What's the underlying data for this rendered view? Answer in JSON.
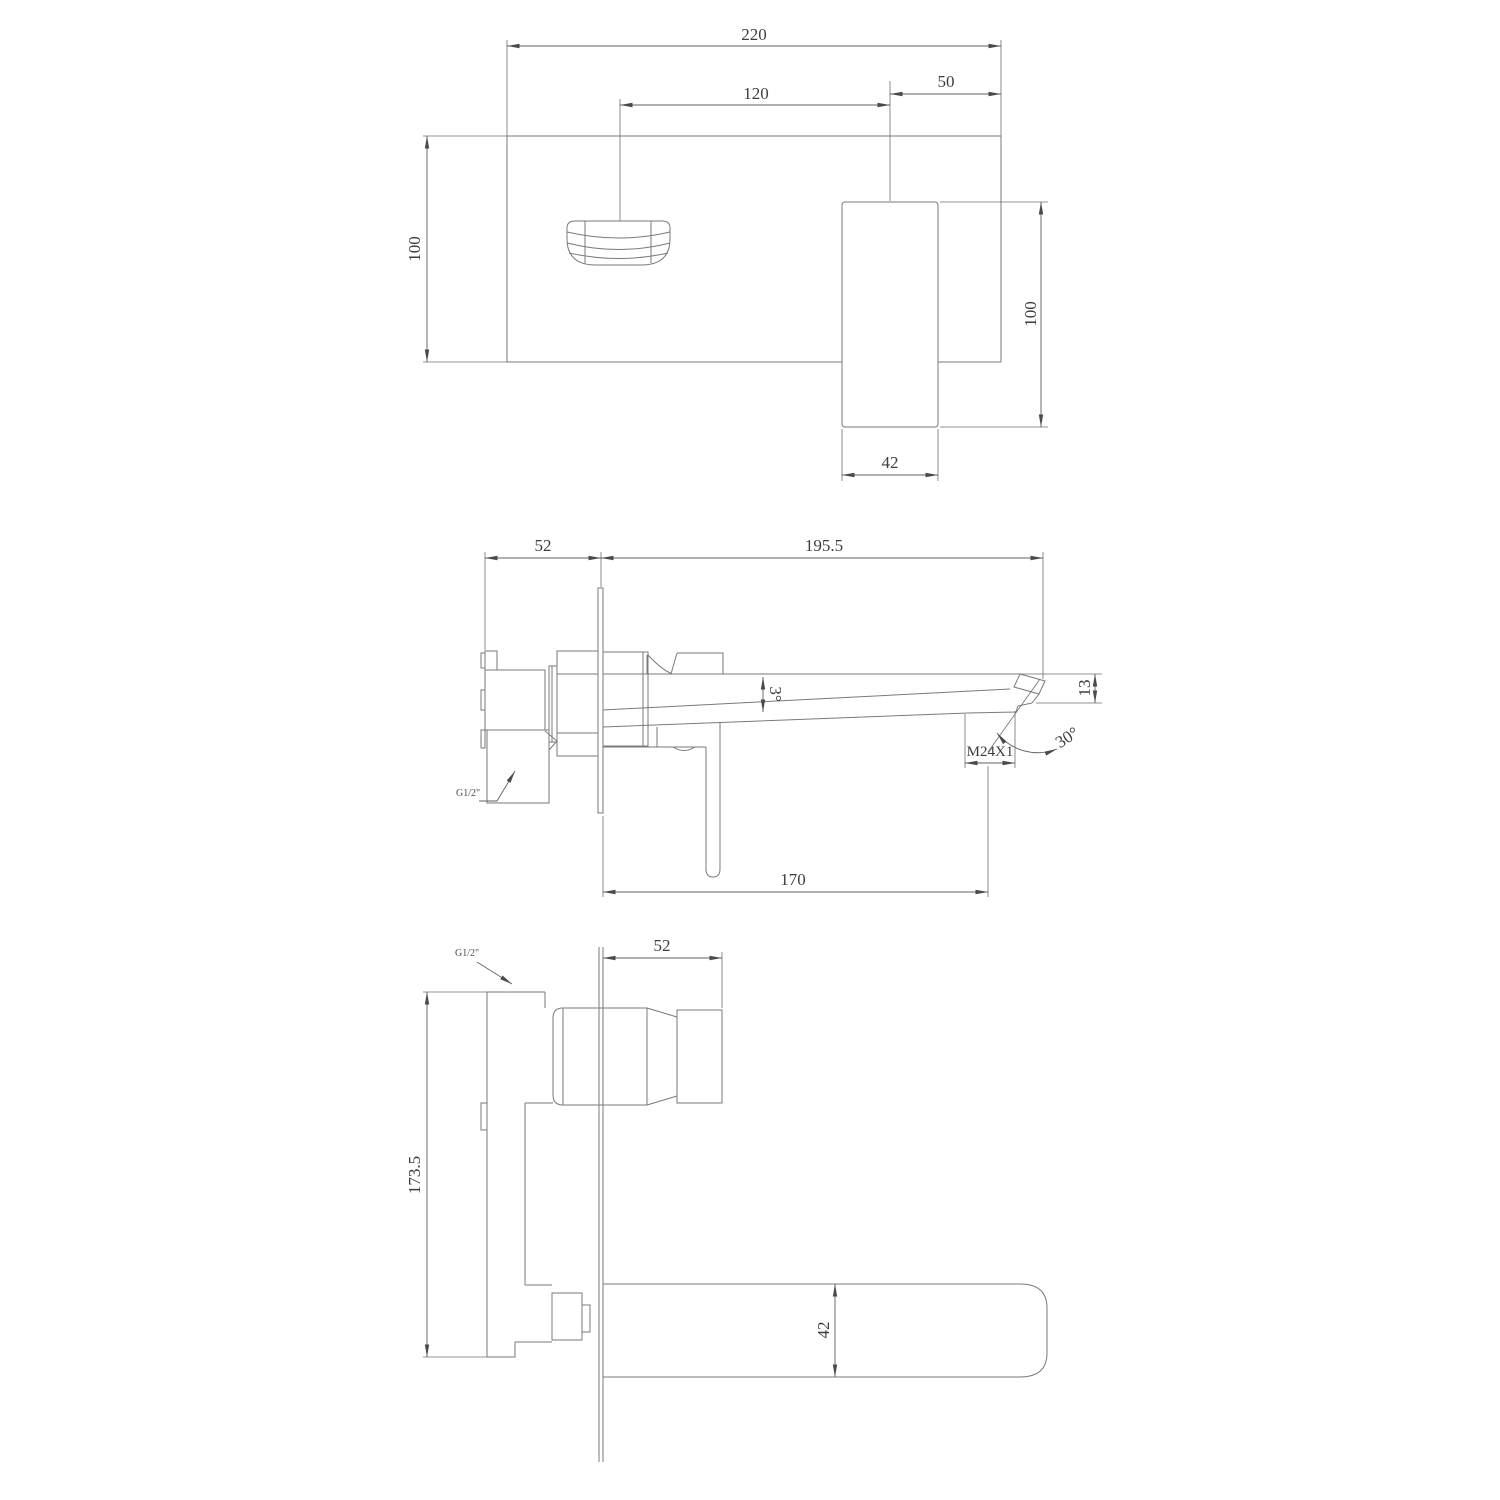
{
  "colors": {
    "background": "#ffffff",
    "outline_line": "#7a7a7a",
    "dimension_line": "#5f5f5f",
    "text": "#3d3d3d"
  },
  "views": {
    "front": {
      "dims": {
        "plate_width": "220",
        "spout_center_offset": "120",
        "handle_center_offset": "50",
        "plate_height": "100",
        "handle_length": "100",
        "handle_width": "42"
      }
    },
    "side": {
      "dims": {
        "embed_depth": "52",
        "spout_reach": "195.5",
        "spout_taper_angle": "3°",
        "tip_height": "13",
        "tip_face_angle": "30°",
        "aerator_thread": "M24X1",
        "inlet_thread": "G1/2\"",
        "aerator_offset": "170"
      }
    },
    "vertical": {
      "dims": {
        "inlet_thread": "G1/2\"",
        "embed_depth": "52",
        "total_height": "173.5",
        "spout_width": "42"
      }
    }
  }
}
